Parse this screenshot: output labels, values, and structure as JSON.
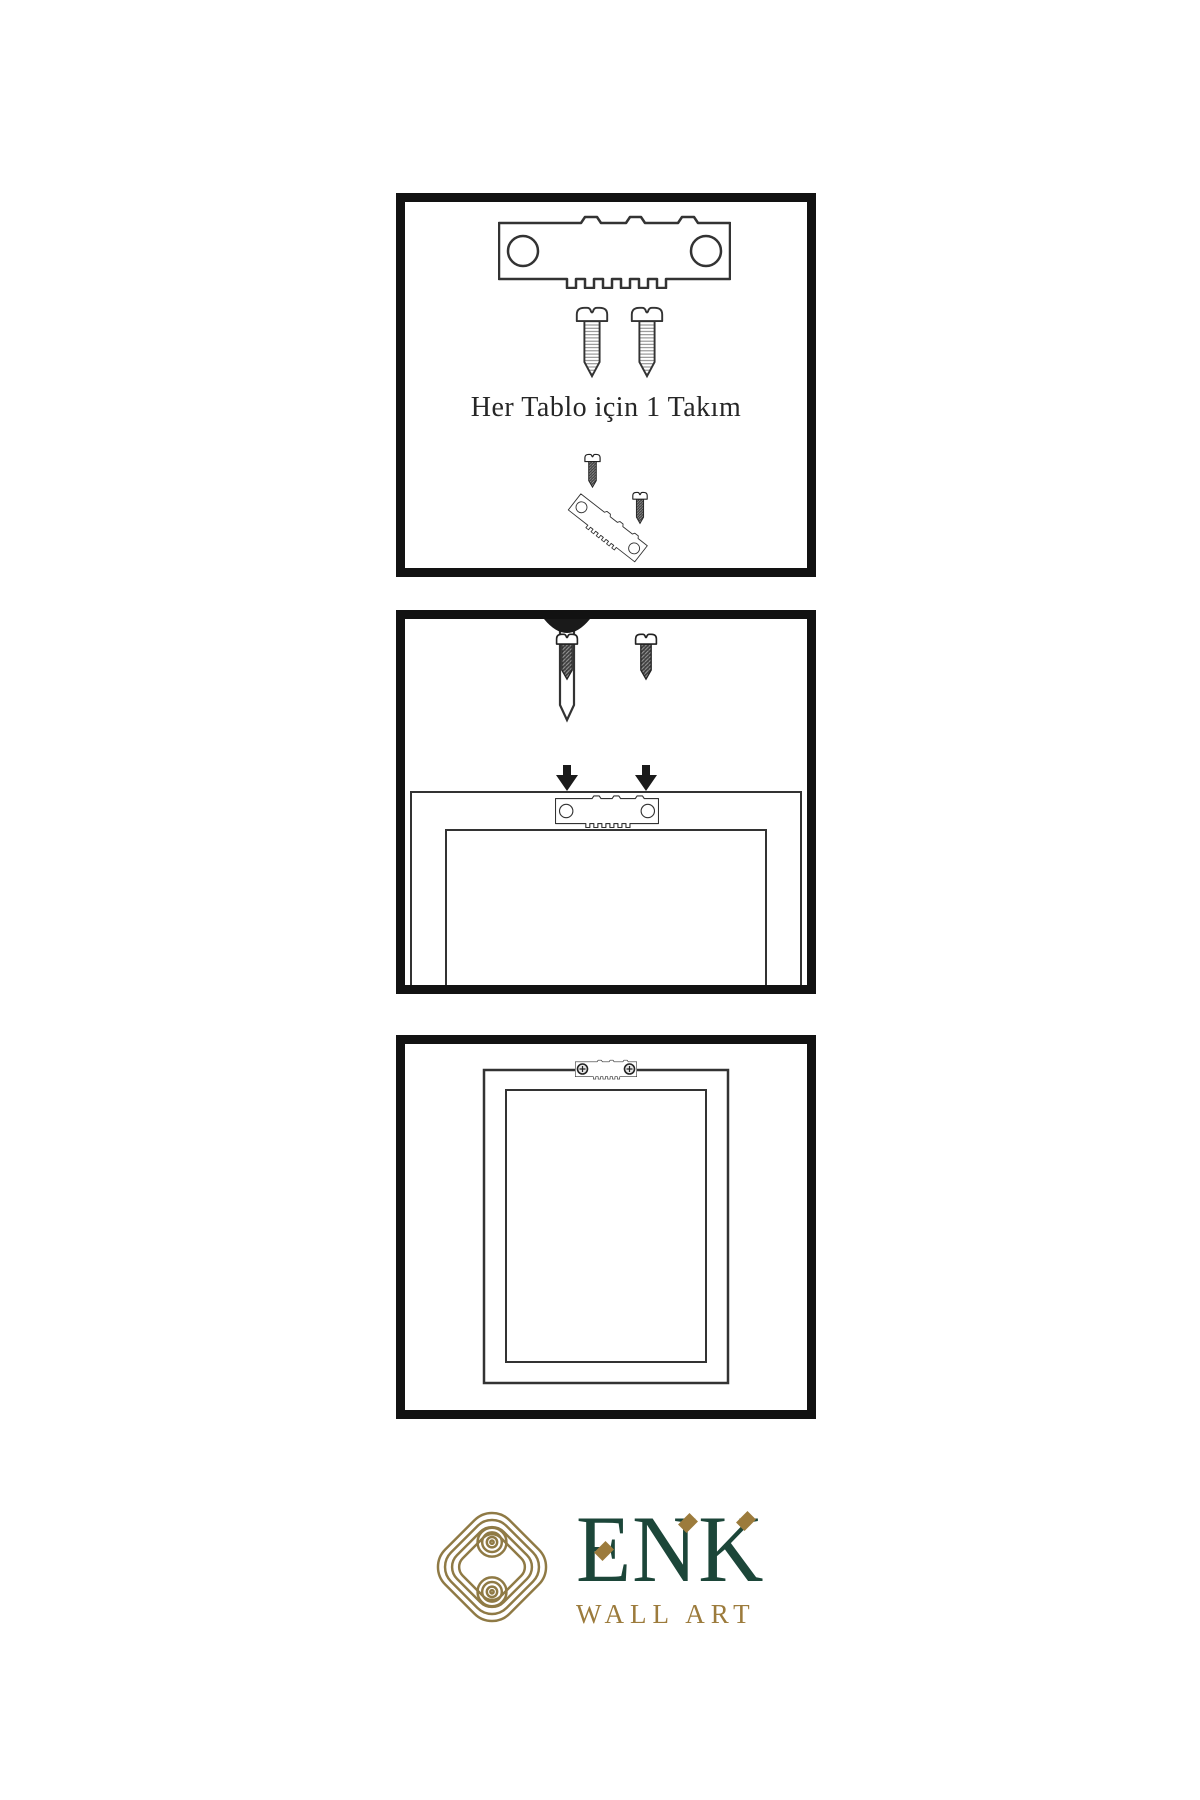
{
  "page": {
    "background_color": "#ffffff",
    "type": "wall-art-hanging-instructions"
  },
  "instructions": {
    "step1": {
      "caption": "Her Tablo için 1 Takım",
      "items": [
        "sawtooth-hanger",
        "two-screws",
        "small-screw-and-tilted-hanger"
      ]
    },
    "step2": {
      "items": [
        "wall-nail",
        "two-screws-with-down-arrows",
        "frame-back-with-sawtooth-hanger"
      ]
    },
    "step3": {
      "items": [
        "hung-frame-with-mounted-hanger"
      ]
    }
  },
  "logo": {
    "wordmark": "ENK",
    "tagline": "WALL ART",
    "brand_green": "#1c4639",
    "brand_gold": "#9c7b3c",
    "icon": "interlocking-knot-icon"
  }
}
